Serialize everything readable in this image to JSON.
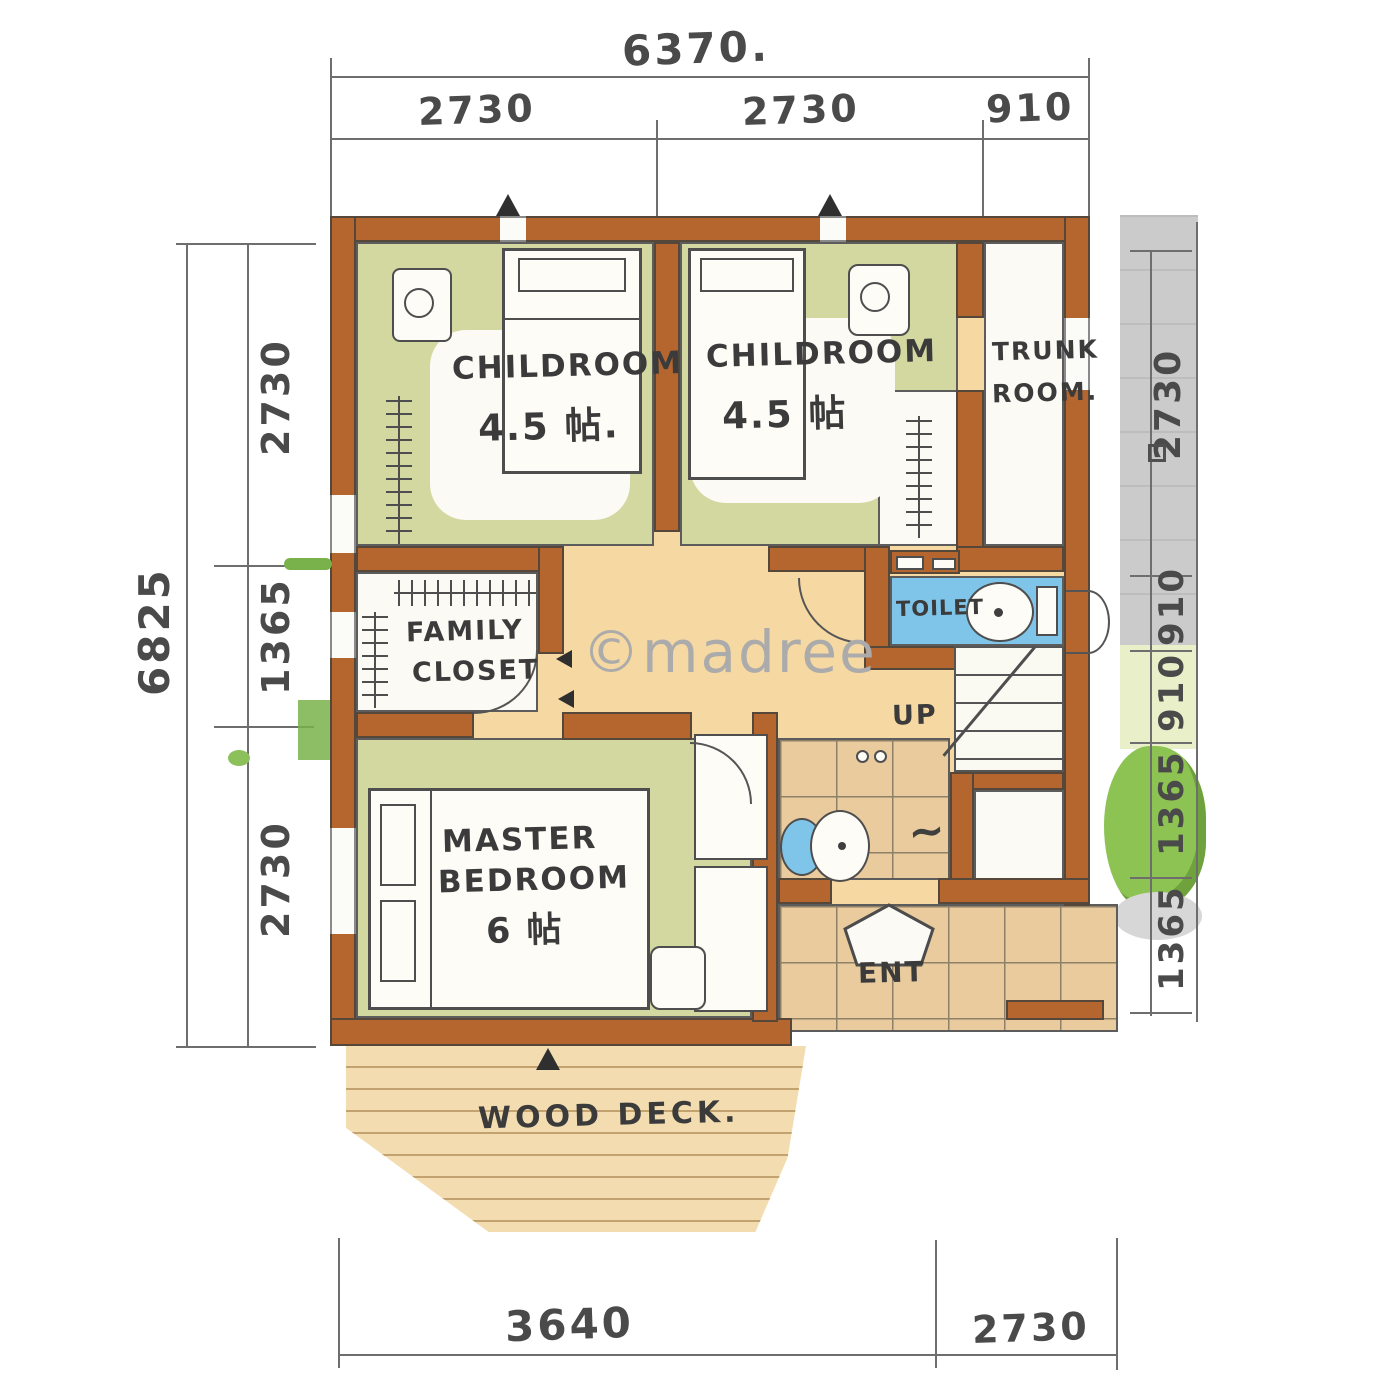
{
  "watermark": "©madree",
  "dimensions": {
    "top": {
      "total": "6370.",
      "segments": [
        "2730",
        "2730",
        "910"
      ]
    },
    "left": {
      "total": "6825",
      "segments": [
        "2730",
        "1365",
        "2730"
      ]
    },
    "right": {
      "segments": [
        "2730",
        "910",
        "910",
        "1365",
        "1365"
      ]
    },
    "bottom": {
      "segments": [
        "3640",
        "2730"
      ]
    }
  },
  "rooms": {
    "childroom_left": {
      "name": "CHILDROOM",
      "area": "4.5 帖."
    },
    "childroom_right": {
      "name": "CHILDROOM",
      "area": "4.5 帖"
    },
    "trunk_room": {
      "line1": "TRUNK",
      "line2": "ROOM."
    },
    "family_closet": {
      "line1": "FAMILY",
      "line2": "CLOSET"
    },
    "toilet": {
      "name": "TOILET"
    },
    "stairs": {
      "label": "UP"
    },
    "master_bedroom": {
      "line1": "MASTER",
      "line2": "BEDROOM",
      "area": "6 帖"
    },
    "entrance": {
      "name": "ENT"
    },
    "wood_deck": {
      "name": "WOOD DECK."
    }
  }
}
